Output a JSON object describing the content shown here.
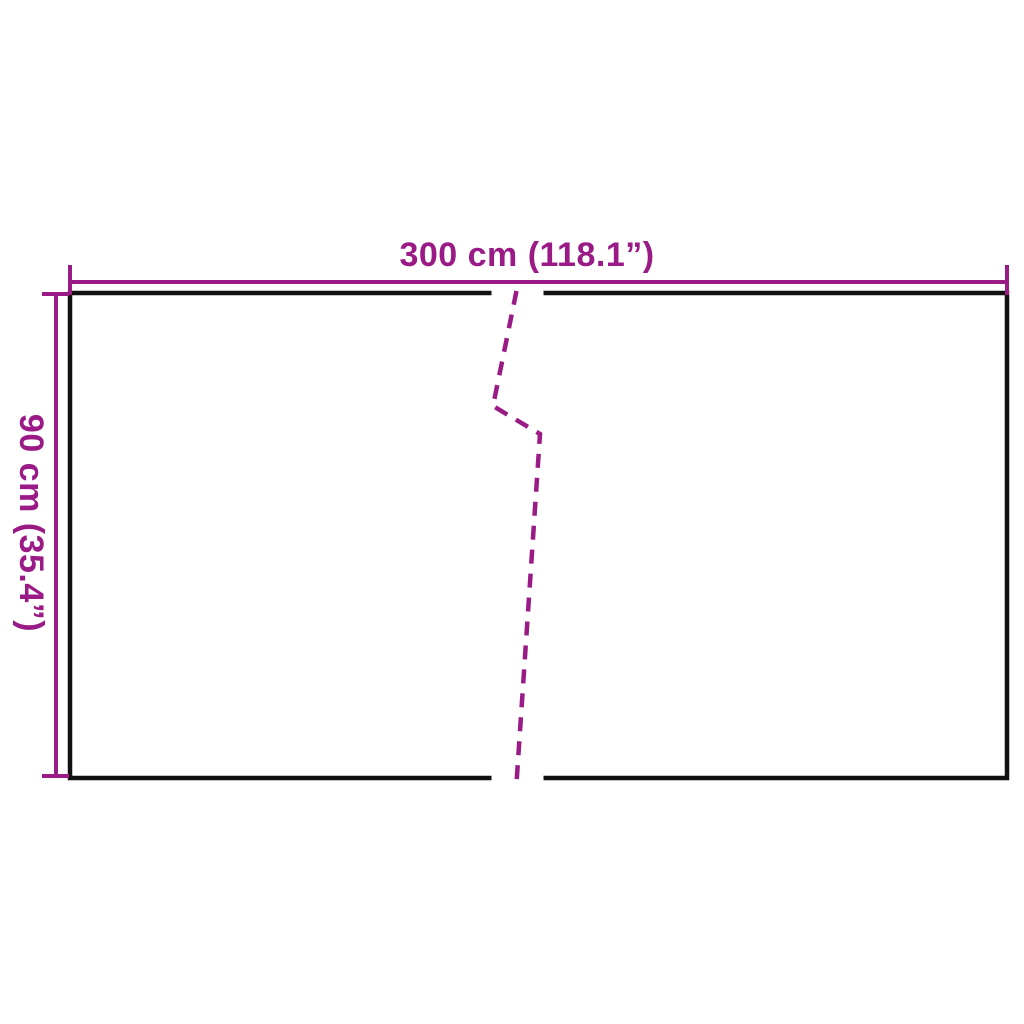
{
  "diagram": {
    "kind": "product dimension drawing",
    "shape": "rectangular panel with center break line",
    "width_dimension": {
      "label": "300 cm (118.1”)",
      "value_cm": 300,
      "value_inch": 118.1
    },
    "height_dimension": {
      "label": "90 cm (35.4”)",
      "value_cm": 90,
      "value_inch": 35.4
    }
  },
  "colors": {
    "accent": "#9A1A86",
    "outline": "#111111",
    "background": "#FFFFFF"
  }
}
